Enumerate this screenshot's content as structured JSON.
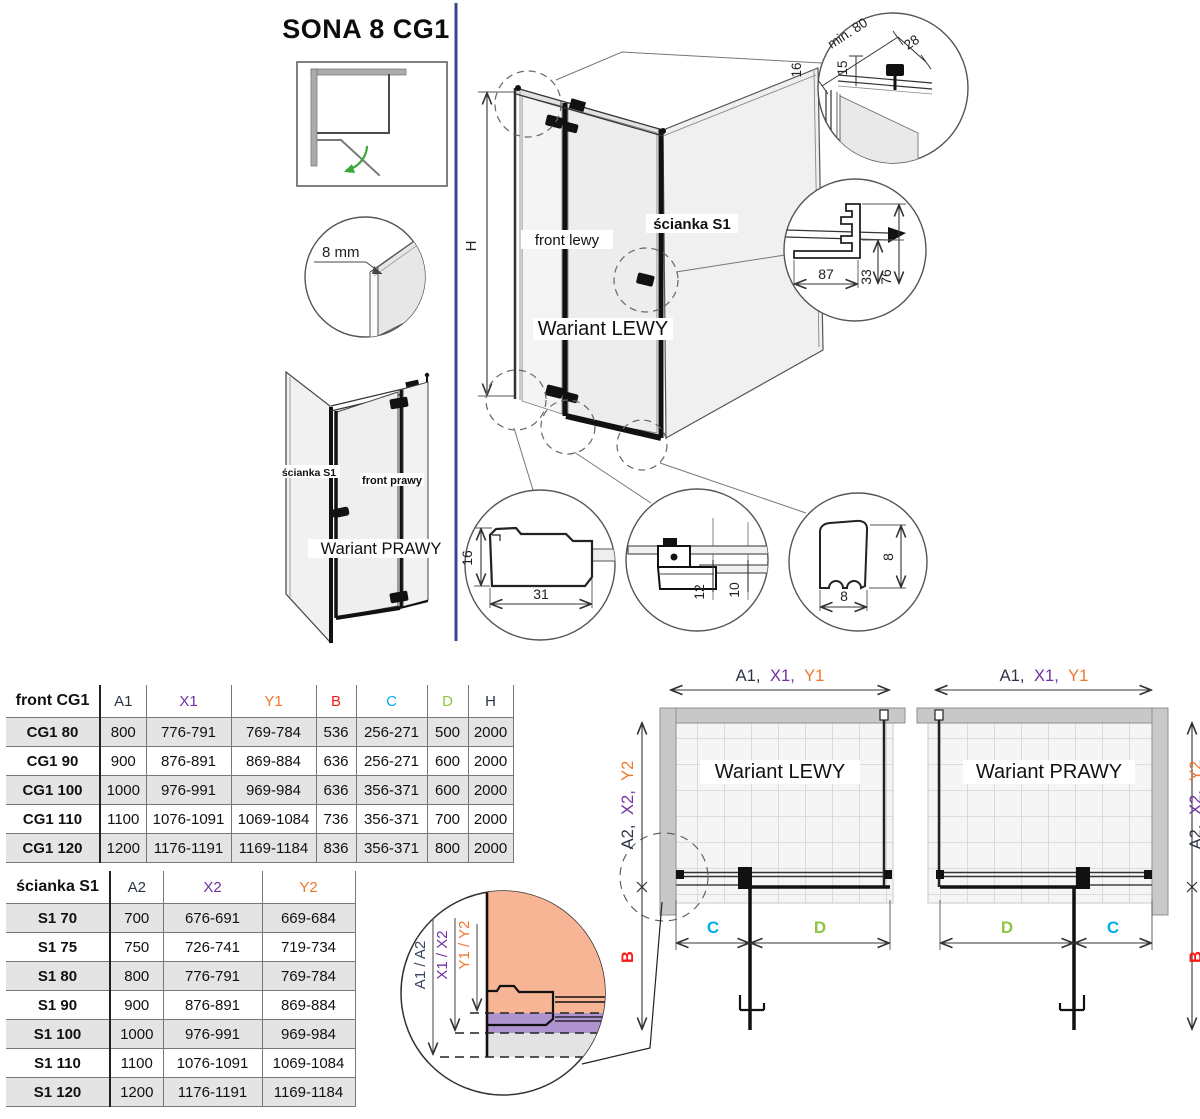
{
  "title": "SONA 8 CG1",
  "colors": {
    "purple": "#7030A0",
    "orange": "#F0762B",
    "red": "#FB1A1A",
    "cyan": "#00AEEF",
    "green": "#8DC63F",
    "navy": "#2B3245",
    "divider": "#38468F",
    "salmon_fill": "#F7B596",
    "violet_fill": "#AE93CF",
    "wall_gray": "#C8C8C8",
    "arrow_green": "#3BA83B"
  },
  "labels": {
    "glass_thickness": "8 mm",
    "front_lewy": "front lewy",
    "front_prawy": "front prawy",
    "scianka_s1": "ścianka S1",
    "wariant_lewy": "Wariant LEWY",
    "wariant_prawy": "Wariant PRAWY",
    "h": "H",
    "b": "B",
    "c": "C",
    "d": "D",
    "a1": "A1,",
    "x1": "X1,",
    "y1": "Y1",
    "a2": "A2,",
    "x2": "X2,",
    "y2": "Y2",
    "a12": "A1 / A2",
    "x12": "X1 / X2",
    "y12": "Y1 / Y2"
  },
  "details": {
    "min80": "min. 80",
    "d28": "28",
    "d15": "15",
    "d16_top": "16",
    "d87": "87",
    "d33": "33",
    "d76": "76",
    "d16": "16",
    "d31": "31",
    "d12": "12",
    "d10": "10",
    "d8_h": "8",
    "d8_w": "8"
  },
  "front_table": {
    "headers": [
      "front CG1",
      "A1",
      "X1",
      "Y1",
      "B",
      "C",
      "D",
      "H"
    ],
    "rows": [
      [
        "CG1 80",
        "800",
        "776-791",
        "769-784",
        "536",
        "256-271",
        "500",
        "2000"
      ],
      [
        "CG1 90",
        "900",
        "876-891",
        "869-884",
        "636",
        "256-271",
        "600",
        "2000"
      ],
      [
        "CG1 100",
        "1000",
        "976-991",
        "969-984",
        "636",
        "356-371",
        "600",
        "2000"
      ],
      [
        "CG1 110",
        "1100",
        "1076-1091",
        "1069-1084",
        "736",
        "356-371",
        "700",
        "2000"
      ],
      [
        "CG1 120",
        "1200",
        "1176-1191",
        "1169-1184",
        "836",
        "356-371",
        "800",
        "2000"
      ]
    ]
  },
  "wall_table": {
    "headers": [
      "ścianka S1",
      "A2",
      "X2",
      "Y2"
    ],
    "rows": [
      [
        "S1 70",
        "700",
        "676-691",
        "669-684"
      ],
      [
        "S1 75",
        "750",
        "726-741",
        "719-734"
      ],
      [
        "S1 80",
        "800",
        "776-791",
        "769-784"
      ],
      [
        "S1 90",
        "900",
        "876-891",
        "869-884"
      ],
      [
        "S1 100",
        "1000",
        "976-991",
        "969-984"
      ],
      [
        "S1 110",
        "1100",
        "1076-1091",
        "1069-1084"
      ],
      [
        "S1 120",
        "1200",
        "1176-1191",
        "1169-1184"
      ]
    ]
  }
}
